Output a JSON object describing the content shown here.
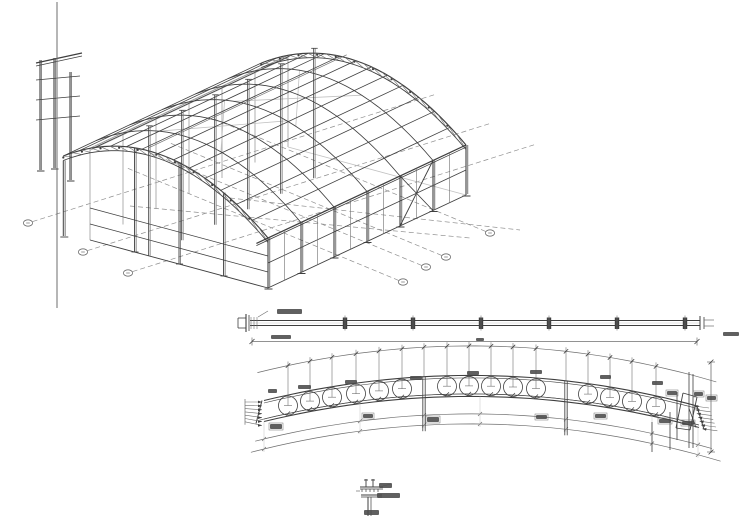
{
  "sheet": {
    "width": 750,
    "height": 516,
    "background": "#ffffff"
  },
  "palette": {
    "ink": "#3f3f3f",
    "mid": "#6e6e6e",
    "light": "#9b9b9b",
    "faint": "#c2c2c2",
    "blob": "#4a4a4a",
    "dash": "#8f8f8f"
  },
  "border_line": {
    "x": 57,
    "y1": 2,
    "y2": 308
  },
  "iso_view": {
    "origin": [
      268,
      288
    ],
    "frame_step": [
      33,
      -15.5
    ],
    "frames": 7,
    "width_vec": [
      -178,
      -48
    ],
    "eave_height": 50,
    "crown_rise": 55,
    "crown_at": 0.33,
    "w_min": -0.15,
    "purlin_stations": 14,
    "mast_height": 130,
    "girt_heights": [
      16,
      32
    ],
    "front_girt_height": 25,
    "brace_bay": 4,
    "bubbles_lower_left": [
      [
        28,
        223
      ],
      [
        83,
        252
      ],
      [
        128,
        273
      ]
    ],
    "bubbles_lower_right": [
      [
        403,
        282
      ],
      [
        426,
        267
      ],
      [
        446,
        257
      ],
      [
        490,
        233
      ]
    ],
    "grid_dir_ll": [
      0.95,
      -0.3
    ],
    "grid_len_ll": 430,
    "grid_dir_lr": [
      -0.92,
      -0.38
    ],
    "grid_len_lr": 300,
    "aux_frame": {
      "cols": [
        [
          40,
          60,
          170
        ],
        [
          54,
          58,
          168
        ],
        [
          70,
          72,
          180
        ]
      ],
      "rails_y": [
        80,
        100,
        120
      ],
      "rail_x": [
        36,
        80
      ]
    }
  },
  "beam_elevation": {
    "x1": 250,
    "x2": 700,
    "y_top": 320.5,
    "y_mid": 323,
    "y_bot": 325.5,
    "end_plate_x": 246,
    "splices": [
      345,
      413,
      481,
      549,
      617,
      685
    ],
    "dim_line": {
      "x1": 252,
      "x2": 697,
      "y": 341.5
    },
    "micro_labels": [
      [
        277,
        309,
        25,
        5
      ],
      [
        271,
        335,
        20,
        4
      ],
      [
        723,
        332,
        16,
        4
      ],
      [
        476,
        338,
        8,
        3
      ]
    ]
  },
  "arch_detail": {
    "p0": [
      264,
      411
    ],
    "c": [
      483,
      358
    ],
    "p1": [
      699,
      417
    ],
    "half_depth": 10.5,
    "circle_x": [
      288,
      310,
      332,
      356,
      379,
      402,
      447,
      469,
      491,
      513,
      536,
      588,
      610,
      632,
      656
    ],
    "circle_r": 9.5,
    "splice_x": [
      424,
      566
    ],
    "arc_offsets": [
      -40,
      8,
      28,
      38
    ],
    "leader_left": {
      "x": 245,
      "len": 17,
      "y0": 402,
      "dy": 3.3,
      "n": 7
    },
    "leader_right": {
      "x0": 694,
      "len": 15,
      "y0": 406,
      "dy": 3.8,
      "n": 7
    },
    "right_dim": {
      "x": 711,
      "y1": 362,
      "y2": 452
    },
    "right_verticals": [
      [
        652,
        422,
        452
      ],
      [
        670,
        412,
        450
      ],
      [
        677,
        392,
        440
      ],
      [
        689,
        372,
        448
      ],
      [
        693,
        374,
        448
      ]
    ],
    "micro_labels_above": [
      [
        268,
        389,
        9,
        4
      ],
      [
        298,
        385,
        13,
        4
      ],
      [
        345,
        380,
        12,
        4
      ],
      [
        410,
        376,
        12,
        4
      ],
      [
        467,
        371,
        12,
        4
      ],
      [
        530,
        370,
        12,
        4
      ],
      [
        600,
        375,
        11,
        4
      ],
      [
        652,
        381,
        11,
        4
      ]
    ],
    "micro_labels_below": [
      [
        270,
        424,
        12,
        5
      ],
      [
        363,
        414,
        10,
        4
      ],
      [
        427,
        417,
        12,
        5
      ],
      [
        536,
        415,
        11,
        4
      ],
      [
        595,
        414,
        11,
        4
      ],
      [
        659,
        419,
        12,
        4
      ],
      [
        682,
        421,
        12,
        4
      ],
      [
        667,
        391,
        10,
        4
      ],
      [
        694,
        392,
        9,
        4
      ],
      [
        707,
        396,
        9,
        4
      ]
    ]
  },
  "section_detail": {
    "cx": 370,
    "top": 478,
    "bottom": 516,
    "micro_labels": [
      [
        379,
        483,
        13,
        5
      ],
      [
        377,
        493,
        23,
        5
      ],
      [
        364,
        510,
        15,
        5
      ]
    ]
  }
}
